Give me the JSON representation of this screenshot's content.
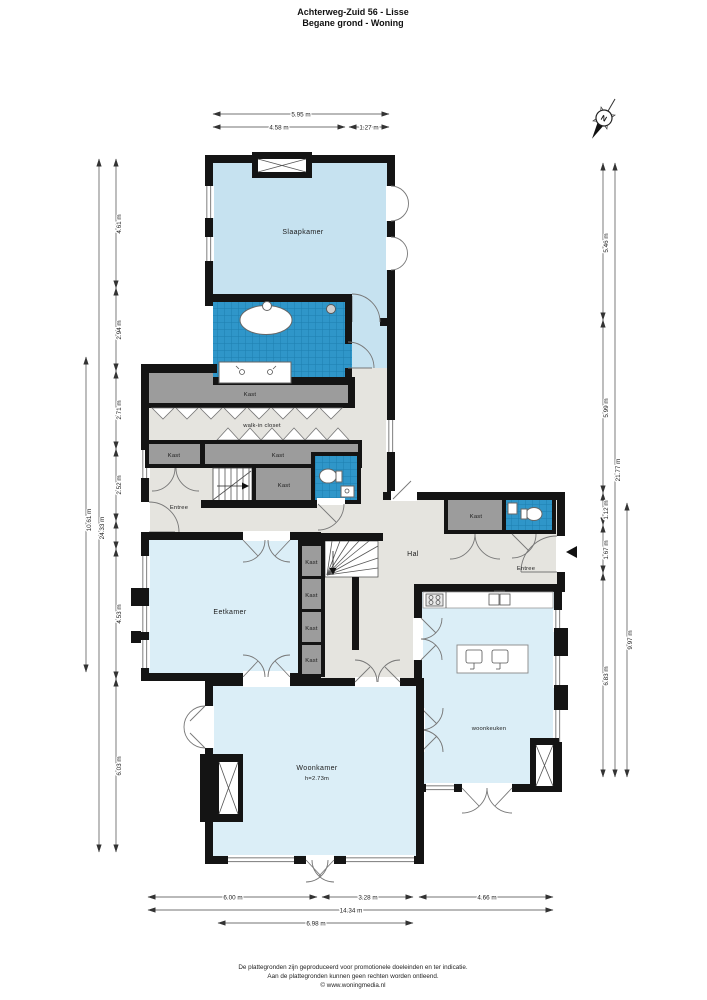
{
  "title": {
    "line1": "Achterweg-Zuid 56 - Lisse",
    "line2": "Begane grond - Woning"
  },
  "compass": {
    "label": "N"
  },
  "rooms": {
    "slaapkamer": "Slaapkamer",
    "kast": "Kast",
    "walk_in_closet": "walk-in closet",
    "entree": "Entree",
    "hal": "Hal",
    "eetkamer": "Eetkamer",
    "woonkamer": "Woonkamer",
    "woonkamer_height": "h=2.73m",
    "woonkeuken": "woonkeuken"
  },
  "dimensions": {
    "top": [
      "5.95 m",
      "4.58 m",
      "1.27 m"
    ],
    "left": [
      "4.61 m",
      "2.94 m",
      "2.71 m",
      "2.52 m",
      "4.53 m",
      "6.03 m"
    ],
    "left_totals": [
      "24.33 m",
      "10.61 m"
    ],
    "right": [
      "5.46 m",
      "5.99 m",
      "1.12 m",
      "1.67 m",
      "6.83 m"
    ],
    "right_totals": [
      "21.77 m",
      "9.97 m"
    ],
    "bottom": [
      "6.00 m",
      "3.28 m",
      "4.66 m"
    ],
    "bottom_totals": [
      "14.34 m",
      "6.98 m"
    ]
  },
  "footer": {
    "line1": "De plattegronden zijn geproduceerd voor promotionele doeleinden en ter indicatie.",
    "line2": "Aan de plattegronden kunnen geen rechten worden ontleend.",
    "line3": "© www.woningmedia.nl"
  },
  "colors": {
    "wall": "#141414",
    "tile_blue": "#2f96c9",
    "tile_line": "#1c7fb0",
    "room_blue_dark": "#c6e2f0",
    "room_blue_light": "#dbeef7",
    "floor_gray": "#e5e4df",
    "closet_gray": "#9c9c9c"
  }
}
